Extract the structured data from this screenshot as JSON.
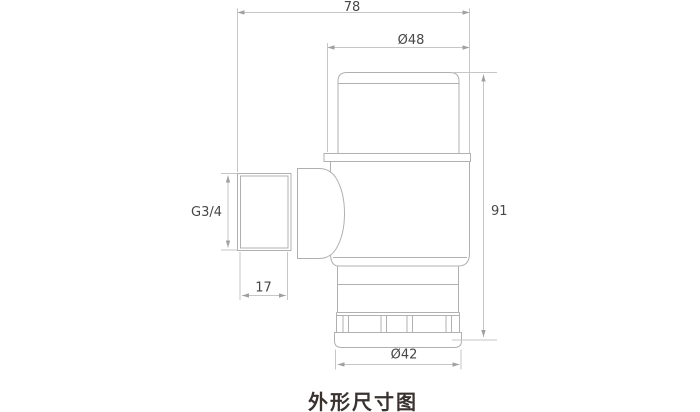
{
  "drawing": {
    "title": "外形尺寸图",
    "labels": {
      "overall_width": "78",
      "cap_diameter": "Ø48",
      "overall_height": "91",
      "inlet_thread": "G3/4",
      "inlet_length": "17",
      "bottom_diameter": "Ø42"
    },
    "colors": {
      "background": "#ffffff",
      "part_line": "#b0b0b0",
      "dim_line": "#c6c6c6",
      "arrow": "#a0a0a0",
      "dim_text": "#474747",
      "title_text": "#39322f"
    }
  }
}
